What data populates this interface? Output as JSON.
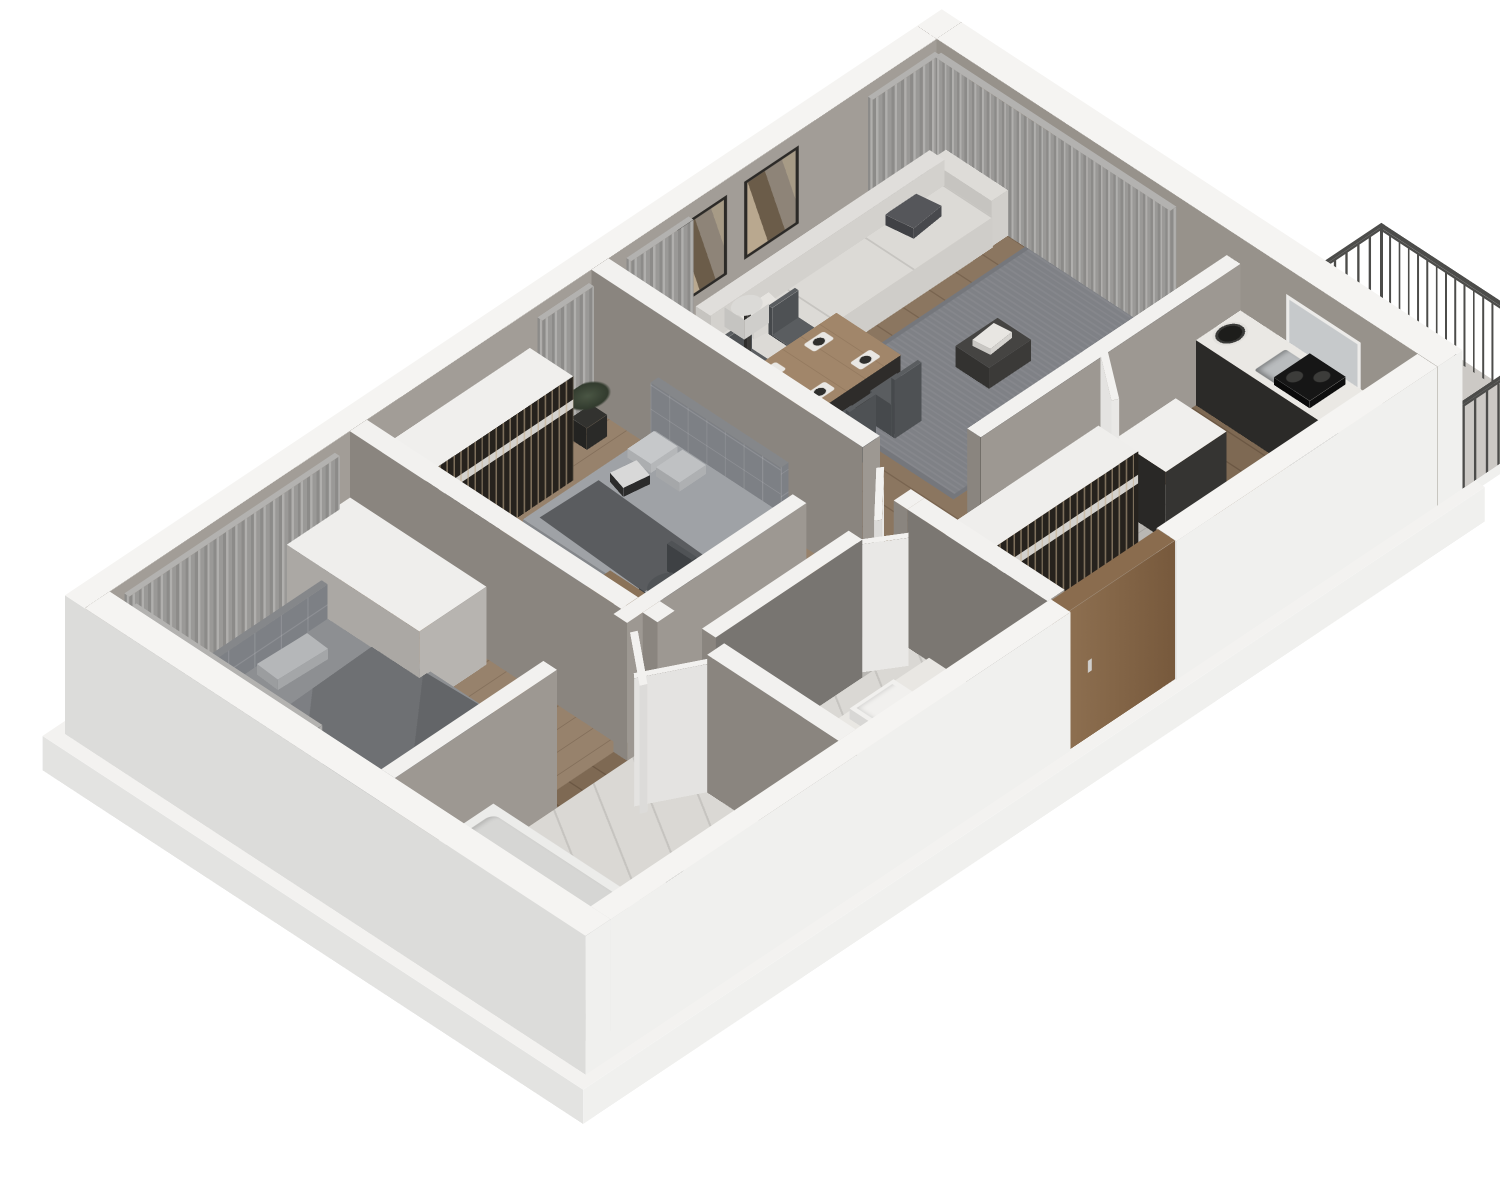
{
  "scene": {
    "label": "3D isometric floor plan of a two-bedroom apartment",
    "view": "axonometric cutaway, rooms open from above",
    "background": "#ffffff"
  },
  "palette": {
    "wallTop": "#f5f4f2",
    "extS": "#f0f0ee",
    "extW": "#dcdcda",
    "innerNW": "#a29d97",
    "innerNE": "#97928b",
    "partTop": "#f2f1ef",
    "partS": "#9d9892",
    "partW": "#8a857f",
    "slabTop": "#f3f2f0",
    "slabS": "#f0f0ee",
    "slabW": "#e3e3e1",
    "woodLiving": "#8b7660",
    "woodBedroom": "#97826c",
    "woodDark": "#7e6953",
    "tile": "#b9b7b3",
    "marble": "#dad8d4",
    "balcFloor": "#ccc9c5",
    "curtain": "#989795",
    "sofa": "#dcdad6",
    "rug": "#7f8186",
    "tableWood": "#a1866a",
    "chair": "#54575a",
    "counterDark": "#2b2a28",
    "counterTop": "#eae8e4",
    "steel": "#b9bcbe",
    "bed": "#8e9194",
    "blanket": "#6e7073",
    "headboard": "#7d8085",
    "tub": "#ececea",
    "doorWood": "#8a6c4e",
    "leaf": "#e9e8e6",
    "tv": "#101010",
    "rail": "#4c4c4a",
    "clothesBg": "#26221d",
    "plant": "#44503e"
  },
  "rooms": {
    "living": {
      "label": "Living room"
    },
    "dining": {
      "label": "Dining area"
    },
    "kitchen": {
      "label": "Kitchen"
    },
    "master": {
      "label": "Bedroom"
    },
    "bedroom2": {
      "label": "Bedroom 2"
    },
    "bath": {
      "label": "Bathroom"
    },
    "wc": {
      "label": "Shower room"
    },
    "hall": {
      "label": "Hallway"
    },
    "entry": {
      "label": "Entry"
    },
    "balcony": {
      "label": "Balcony"
    }
  },
  "furniture": {
    "sofa": {
      "label": "Sofa"
    },
    "rug": {
      "label": "Area rug"
    },
    "coffee_table": {
      "label": "Coffee table"
    },
    "wall_art": {
      "label": "Wall art"
    },
    "floor_lamp": {
      "label": "Floor lamp"
    },
    "dining_table": {
      "label": "Dining table"
    },
    "dining_chair": {
      "label": "Dining chair"
    },
    "island": {
      "label": "Kitchen island"
    },
    "counter": {
      "label": "Kitchen counter"
    },
    "cooktop": {
      "label": "Cooktop"
    },
    "sink": {
      "label": "Sink"
    },
    "bed_master": {
      "label": "Double bed"
    },
    "bed_single": {
      "label": "Bed"
    },
    "wardrobe": {
      "label": "Open wardrobe"
    },
    "dresser": {
      "label": "Dresser"
    },
    "desk": {
      "label": "Desk"
    },
    "tv": {
      "label": "TV"
    },
    "bathtub": {
      "label": "Bathtub"
    },
    "vanity": {
      "label": "Washbasin vanity"
    },
    "entry_door": {
      "label": "Entrance door"
    },
    "door": {
      "label": "Interior door"
    },
    "curtains": {
      "label": "Curtains"
    },
    "railing": {
      "label": "Balcony railing"
    },
    "plant": {
      "label": "Plant"
    }
  }
}
